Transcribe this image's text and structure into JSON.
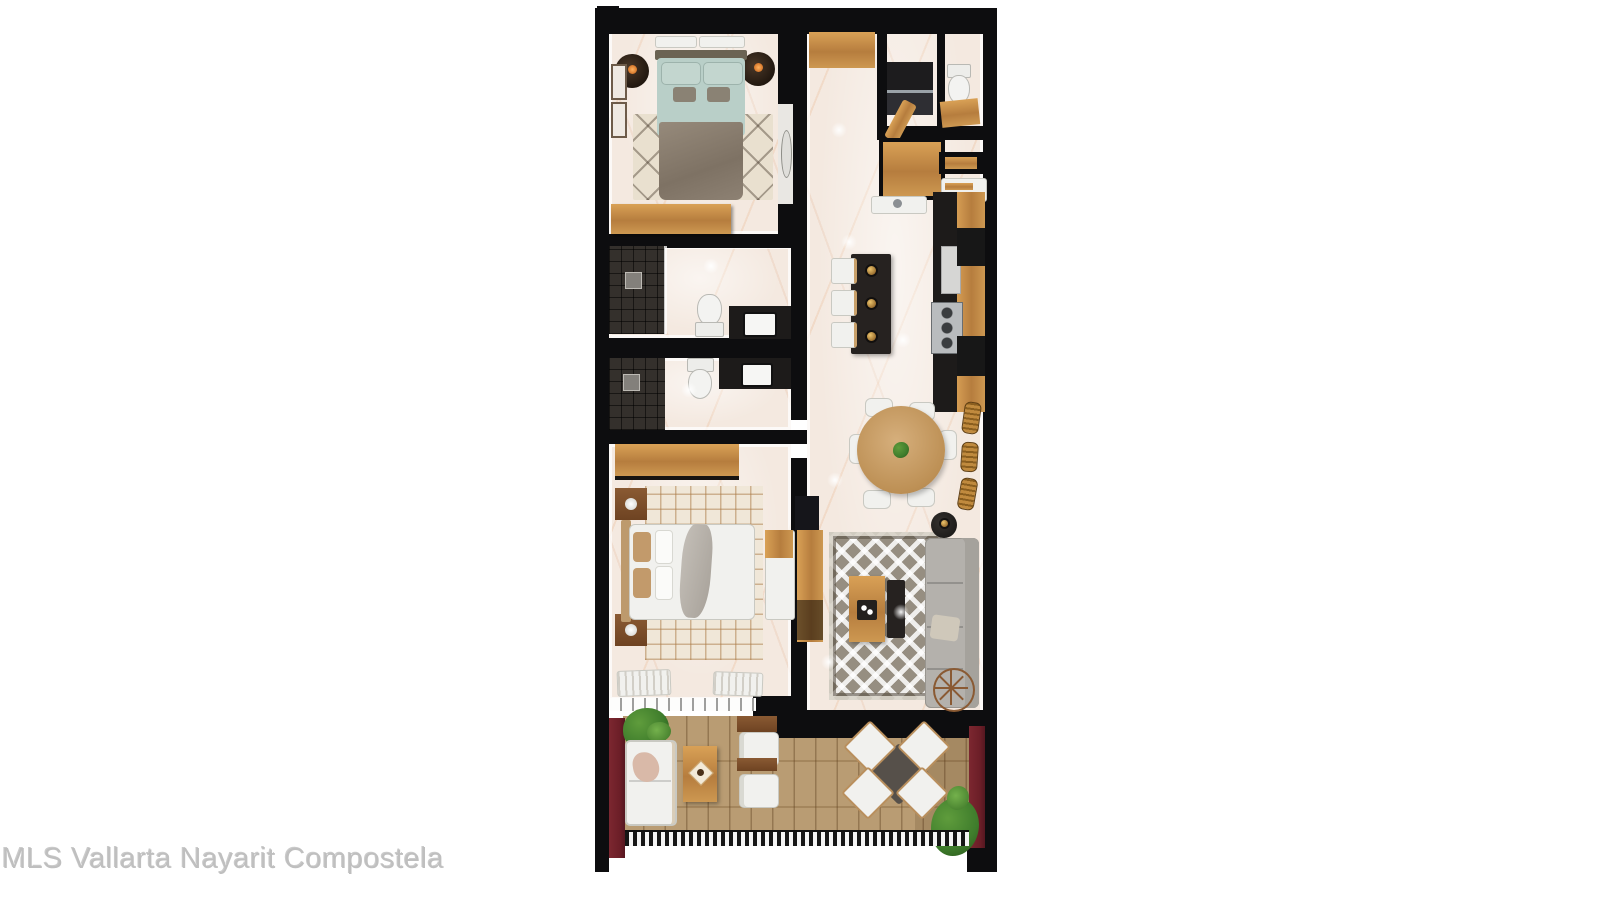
{
  "watermark": {
    "text": "MLS Vallarta Nayarit Compostela"
  },
  "palette": {
    "background": "#ffffff",
    "wall": "#0d0d0f",
    "marble": "#f4e9e0",
    "vein": "#e2985e",
    "wood": "#c8924f",
    "wood_dark": "#7c5128",
    "deck": "#b5966a",
    "maroon": "#6b1e27",
    "tile_dark": "#34302c",
    "island": "#262220",
    "counter_black": "#1d1b1a",
    "stainless": "#b9bcbe",
    "bed_teal": "#b9cfc8",
    "bed_taupe": "#8b8072",
    "rug_cream": "#e9e0cf",
    "rug_gray": "#968e81",
    "sofa_gray": "#b4b1ac",
    "white_furniture": "#f1f1ee",
    "bronze": "#a9742f",
    "plant_green": "#3f7d2c",
    "watermark_gray": "#bfbfbf"
  },
  "plan": {
    "type": "apartment-floor-plan-render",
    "view": "top-down",
    "rooms": [
      "bedroom-1",
      "bathroom-1",
      "bathroom-2",
      "bedroom-2",
      "entry-hall",
      "laundry",
      "powder-bath",
      "kitchen",
      "dining",
      "living",
      "terrace"
    ]
  }
}
